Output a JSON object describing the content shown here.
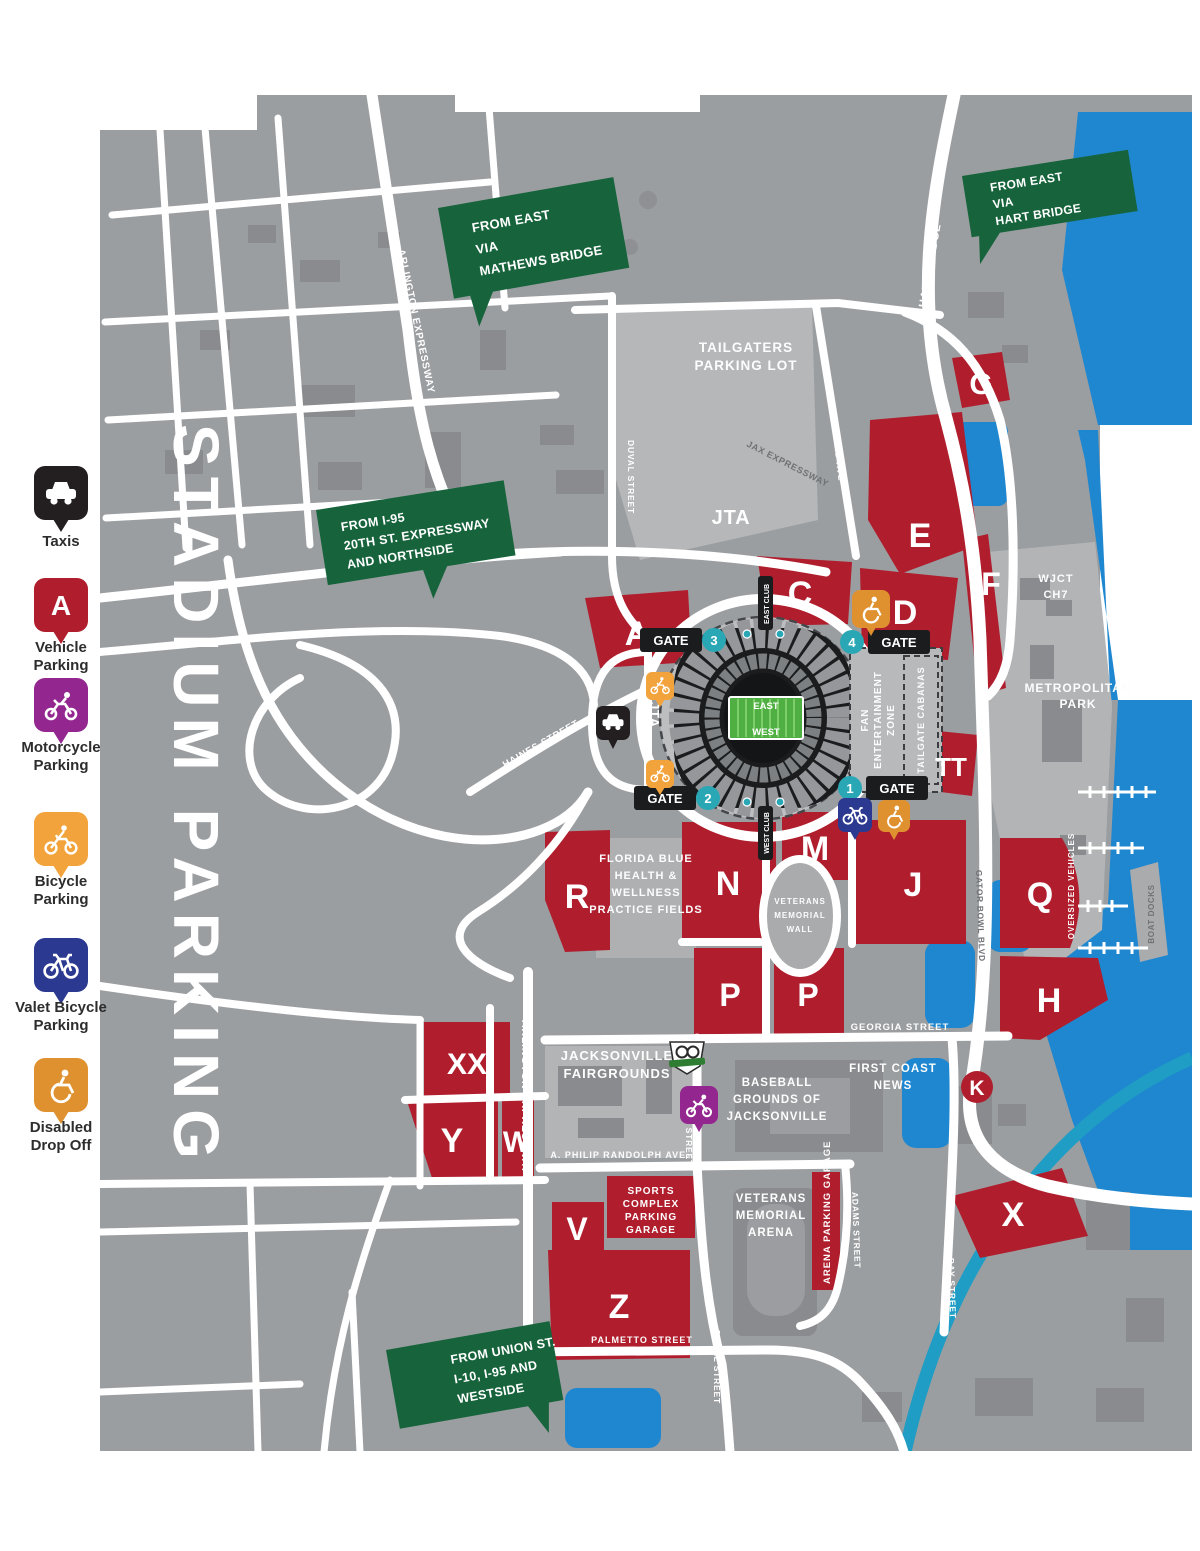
{
  "title": "STADIUM PARKING",
  "legend": {
    "items": [
      {
        "name": "taxis",
        "label1": "Taxis",
        "label2": "",
        "color": "#231f20"
      },
      {
        "name": "vehicle-parking",
        "letter": "A",
        "label1": "Vehicle",
        "label2": "Parking",
        "color": "#b01e2e"
      },
      {
        "name": "motorcycle-parking",
        "label1": "Motorcycle",
        "label2": "Parking",
        "color": "#93278f"
      },
      {
        "name": "bicycle-parking",
        "label1": "Bicycle",
        "label2": "Parking",
        "color": "#f2a33c"
      },
      {
        "name": "valet-bicycle-parking",
        "label1": "Valet Bicycle",
        "label2": "Parking",
        "color": "#2b3990"
      },
      {
        "name": "disabled-drop-off",
        "label1": "Disabled",
        "label2": "Drop Off",
        "color": "#e0912f"
      }
    ]
  },
  "signs": {
    "mathews": {
      "l1": "FROM EAST",
      "l2": "VIA",
      "l3": "MATHEWS BRIDGE"
    },
    "hart": {
      "l1": "FROM EAST",
      "l2": "VIA",
      "l3": "HART BRIDGE"
    },
    "i95": {
      "l1": "FROM I-95",
      "l2": "20TH ST. EXPRESSWAY",
      "l3": "AND NORTHSIDE"
    },
    "union": {
      "l1": "FROM UNION ST.",
      "l2": "I-10, I-95 AND",
      "l3": "WESTSIDE"
    }
  },
  "lots": {
    "A": "A",
    "C": "C",
    "D": "D",
    "E": "E",
    "F": "F",
    "G": "G",
    "H": "H",
    "J": "J",
    "K": "K",
    "M": "M",
    "N": "N",
    "P1": "P",
    "P2": "P",
    "Q": "Q",
    "R": "R",
    "TT": "TT",
    "V": "V",
    "W": "W",
    "X": "X",
    "XX": "XX",
    "Y": "Y",
    "Z": "Z"
  },
  "areas": {
    "tailgaters": {
      "l1": "TAILGATERS",
      "l2": "PARKING LOT"
    },
    "wjct": {
      "l1": "WJCT",
      "l2": "CH7"
    },
    "metropolitan": {
      "l1": "METROPOLITAN",
      "l2": "PARK"
    },
    "florida_blue": {
      "l1": "FLORIDA BLUE",
      "l2": "HEALTH &",
      "l3": "WELLNESS",
      "l4": "PRACTICE FIELDS"
    },
    "veterans_wall": {
      "l1": "VETERANS",
      "l2": "MEMORIAL",
      "l3": "WALL"
    },
    "fairgrounds": {
      "l1": "JACKSONVILLE",
      "l2": "FAIRGROUNDS"
    },
    "baseball": {
      "l1": "BASEBALL",
      "l2": "GROUNDS OF",
      "l3": "JACKSONVILLE"
    },
    "first_coast": {
      "l1": "FIRST COAST",
      "l2": "NEWS"
    },
    "arena": {
      "l1": "VETERANS",
      "l2": "MEMORIAL",
      "l3": "ARENA"
    },
    "sports_garage": {
      "l1": "SPORTS",
      "l2": "COMPLEX",
      "l3": "PARKING",
      "l4": "GARAGE"
    },
    "arena_garage": "ARENA PARKING GARAGE",
    "fan_zone": {
      "l1": "FAN",
      "l2": "ENTERTAINMENT",
      "l3": "ZONE"
    },
    "cabanas": "TAILGATE CABANAS",
    "oversized": "OVERSIZED VEHICLES",
    "boat_docks": "BOAT DOCKS"
  },
  "streets": {
    "arlington_n": "ARLINGTON EXPRESSWAY",
    "arlington_s": "ARLINGTON EXPRESSWAY",
    "hart_bridge": "HART BRIDGE",
    "haines": "HAINES STREET",
    "duval_n": "DUVAL STREET",
    "duval_mid": "DUVAL STREET",
    "duval_s": "DUVAL STREET",
    "talleyrand": "TALLEYRAND AVE",
    "jax_expwy": "JAX EXPRESSWAY",
    "georgia": "GEORGIA STREET",
    "randolph": "A. PHILIP RANDOLPH AVE.",
    "palmetto": "PALMETTO STREET",
    "adams": "ADAMS STREET",
    "bay": "BAY STREET",
    "gator_bowl": "GATOR BOWL BLVD",
    "jta_main": "JTA",
    "jta_loop": "JTA"
  },
  "stadium": {
    "east": "EAST",
    "west": "WEST",
    "east_club": "EAST CLUB",
    "west_club": "WEST CLUB"
  },
  "gates": {
    "label": "GATE",
    "n1": "1",
    "n2": "2",
    "n3": "3",
    "n4": "4"
  }
}
